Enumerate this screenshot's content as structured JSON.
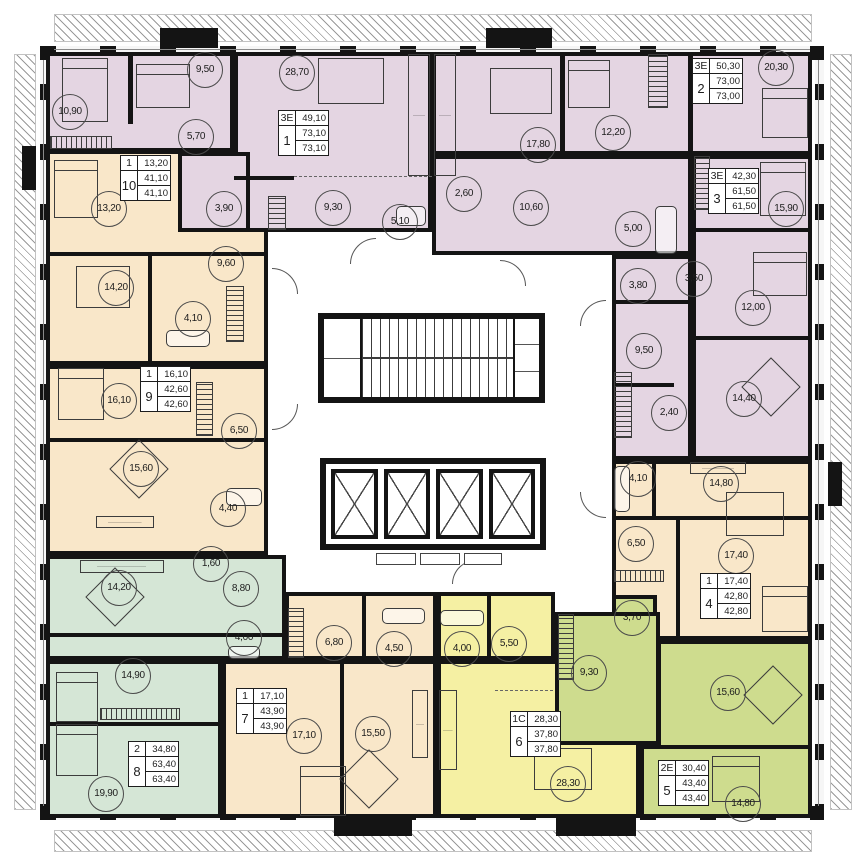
{
  "title": "Residential tower floor plan",
  "colors": {
    "wall": "#141414",
    "purple": "#e4d5e2",
    "peach": "#f9e7c9",
    "mint": "#d5e6d6",
    "yellow": "#f5f0a3",
    "lime": "#cedc8e"
  },
  "apartments": [
    {
      "number": "1",
      "type": "3Е",
      "values": [
        "49,10",
        "73,10",
        "73,10"
      ],
      "color": "#e4d5e2",
      "info_pos": [
        278,
        110
      ],
      "rooms": [
        {
          "area": "10,90",
          "x": 70,
          "y": 112
        },
        {
          "area": "9,50",
          "x": 205,
          "y": 70
        },
        {
          "area": "5,70",
          "x": 196,
          "y": 137
        },
        {
          "area": "28,70",
          "x": 297,
          "y": 73
        },
        {
          "area": "9,30",
          "x": 333,
          "y": 208
        },
        {
          "area": "5,10",
          "x": 400,
          "y": 222
        },
        {
          "area": "3,90",
          "x": 224,
          "y": 209
        }
      ]
    },
    {
      "number": "2",
      "type": "3Е",
      "values": [
        "50,30",
        "73,00",
        "73,00"
      ],
      "color": "#e4d5e2",
      "info_pos": [
        692,
        58
      ],
      "rooms": [
        {
          "area": "20,30",
          "x": 776,
          "y": 68
        },
        {
          "area": "17,80",
          "x": 538,
          "y": 145
        },
        {
          "area": "12,20",
          "x": 613,
          "y": 133
        },
        {
          "area": "10,60",
          "x": 531,
          "y": 208
        },
        {
          "area": "2,60",
          "x": 464,
          "y": 194
        },
        {
          "area": "5,00",
          "x": 633,
          "y": 229
        }
      ]
    },
    {
      "number": "3",
      "type": "3Е",
      "values": [
        "42,30",
        "61,50",
        "61,50"
      ],
      "color": "#e4d5e2",
      "info_pos": [
        708,
        168
      ],
      "rooms": [
        {
          "area": "15,90",
          "x": 786,
          "y": 209
        },
        {
          "area": "12,00",
          "x": 753,
          "y": 308
        },
        {
          "area": "3,80",
          "x": 638,
          "y": 286
        },
        {
          "area": "3,50",
          "x": 694,
          "y": 279
        },
        {
          "area": "9,50",
          "x": 644,
          "y": 351
        },
        {
          "area": "2,40",
          "x": 669,
          "y": 413
        },
        {
          "area": "14,40",
          "x": 744,
          "y": 399
        }
      ]
    },
    {
      "number": "4",
      "type": "1",
      "values": [
        "17,40",
        "42,80",
        "42,80"
      ],
      "color": "#f9e7c9",
      "info_pos": [
        700,
        573
      ],
      "rooms": [
        {
          "area": "4,10",
          "x": 638,
          "y": 479
        },
        {
          "area": "14,80",
          "x": 721,
          "y": 484
        },
        {
          "area": "6,50",
          "x": 636,
          "y": 544
        },
        {
          "area": "17,40",
          "x": 736,
          "y": 556
        }
      ]
    },
    {
      "number": "5",
      "type": "2Е",
      "values": [
        "30,40",
        "43,40",
        "43,40"
      ],
      "color": "#cedc8e",
      "info_pos": [
        658,
        760
      ],
      "rooms": [
        {
          "area": "3,70",
          "x": 632,
          "y": 618
        },
        {
          "area": "9,30",
          "x": 589,
          "y": 673
        },
        {
          "area": "15,60",
          "x": 728,
          "y": 693
        },
        {
          "area": "14,80",
          "x": 743,
          "y": 804
        }
      ]
    },
    {
      "number": "6",
      "type": "1С",
      "values": [
        "28,30",
        "37,80",
        "37,80"
      ],
      "color": "#f5f0a3",
      "info_pos": [
        510,
        711
      ],
      "rooms": [
        {
          "area": "4,00",
          "x": 462,
          "y": 649
        },
        {
          "area": "5,50",
          "x": 509,
          "y": 644
        },
        {
          "area": "28,30",
          "x": 568,
          "y": 784
        }
      ]
    },
    {
      "number": "7",
      "type": "1",
      "values": [
        "17,10",
        "43,90",
        "43,90"
      ],
      "color": "#f9e7c9",
      "info_pos": [
        236,
        688
      ],
      "rooms": [
        {
          "area": "6,80",
          "x": 334,
          "y": 643
        },
        {
          "area": "4,50",
          "x": 394,
          "y": 649
        },
        {
          "area": "17,10",
          "x": 304,
          "y": 736
        },
        {
          "area": "15,50",
          "x": 373,
          "y": 734
        }
      ]
    },
    {
      "number": "8",
      "type": "2",
      "values": [
        "34,80",
        "63,40",
        "63,40"
      ],
      "color": "#d5e6d6",
      "info_pos": [
        128,
        741
      ],
      "rooms": [
        {
          "area": "14,20",
          "x": 119,
          "y": 588
        },
        {
          "area": "1,60",
          "x": 211,
          "y": 564
        },
        {
          "area": "8,80",
          "x": 241,
          "y": 589
        },
        {
          "area": "4,00",
          "x": 244,
          "y": 638
        },
        {
          "area": "14,90",
          "x": 133,
          "y": 676
        },
        {
          "area": "19,90",
          "x": 106,
          "y": 794
        }
      ]
    },
    {
      "number": "9",
      "type": "1",
      "values": [
        "16,10",
        "42,60",
        "42,60"
      ],
      "color": "#f9e7c9",
      "info_pos": [
        140,
        366
      ],
      "rooms": [
        {
          "area": "16,10",
          "x": 119,
          "y": 401
        },
        {
          "area": "6,50",
          "x": 239,
          "y": 431
        },
        {
          "area": "15,60",
          "x": 141,
          "y": 469
        },
        {
          "area": "4,40",
          "x": 228,
          "y": 509
        }
      ]
    },
    {
      "number": "10",
      "type": "1",
      "values": [
        "13,20",
        "41,10",
        "41,10"
      ],
      "color": "#f9e7c9",
      "info_pos": [
        120,
        155
      ],
      "rooms": [
        {
          "area": "13,20",
          "x": 109,
          "y": 209
        },
        {
          "area": "14,20",
          "x": 116,
          "y": 288
        },
        {
          "area": "9,60",
          "x": 226,
          "y": 264
        },
        {
          "area": "4,10",
          "x": 193,
          "y": 319
        }
      ]
    }
  ],
  "core": {
    "staircase": "stairs",
    "elevator_count": 4
  }
}
